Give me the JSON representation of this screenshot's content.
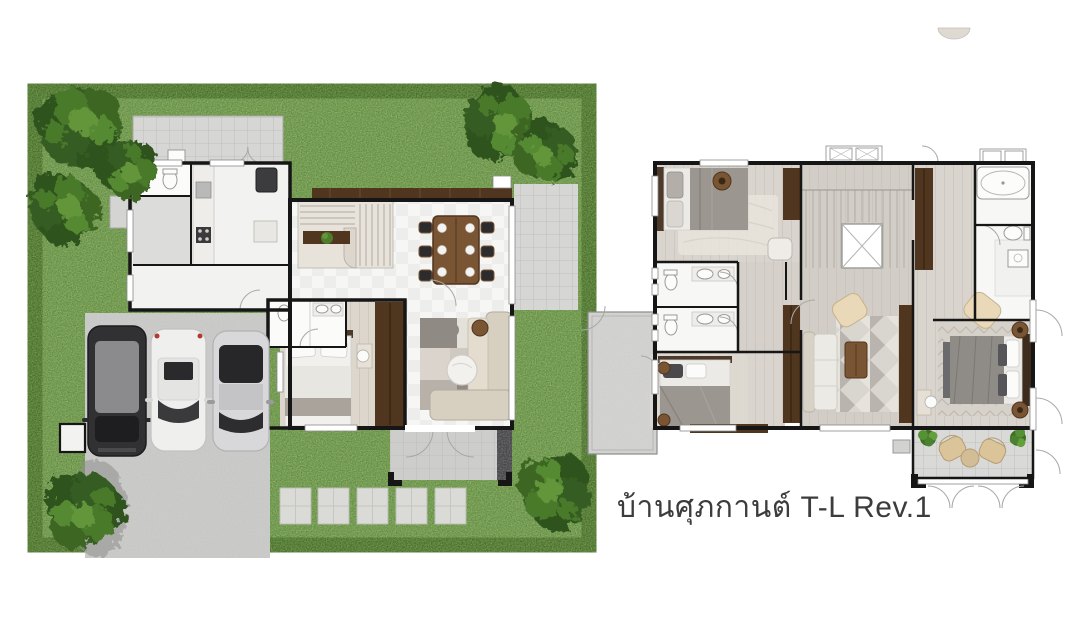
{
  "caption": {
    "text": "บ้านศุภกานต์ T-L Rev.1"
  },
  "palette": {
    "bg": "#ffffff",
    "caption": "#3c3c3c",
    "lawn": "#6b9346",
    "hedge": "#41661f",
    "tree_dark": "#2e521b",
    "tree_light": "#63953a",
    "concrete": "#cbcbc9",
    "tile": "#d6d6d4",
    "floor_white": "#f5f5f3",
    "wood_floor": "#ddd6cc",
    "wall": "#161616",
    "walnut": "#50351f",
    "walnut_light": "#7a5533",
    "sofa_beige": "#d7cfc0",
    "blanket_gray": "#9b968f",
    "car_dark": "#313133",
    "car_white": "#efefed",
    "car_silver": "#d8d8da",
    "rattan": "#dcc49a"
  },
  "plans": {
    "ground_floor": {
      "name": "ground-floor-plan",
      "cars": [
        "dark-mpv",
        "white-sedan",
        "silver-sedan"
      ],
      "tree_count": 6,
      "stepping_stone_count": 5,
      "dining_seat_count": 6
    },
    "second_floor": {
      "name": "second-floor-plan",
      "bedroom_count": 3,
      "bathroom_count": 3,
      "terrace_chair_count": 2
    }
  }
}
